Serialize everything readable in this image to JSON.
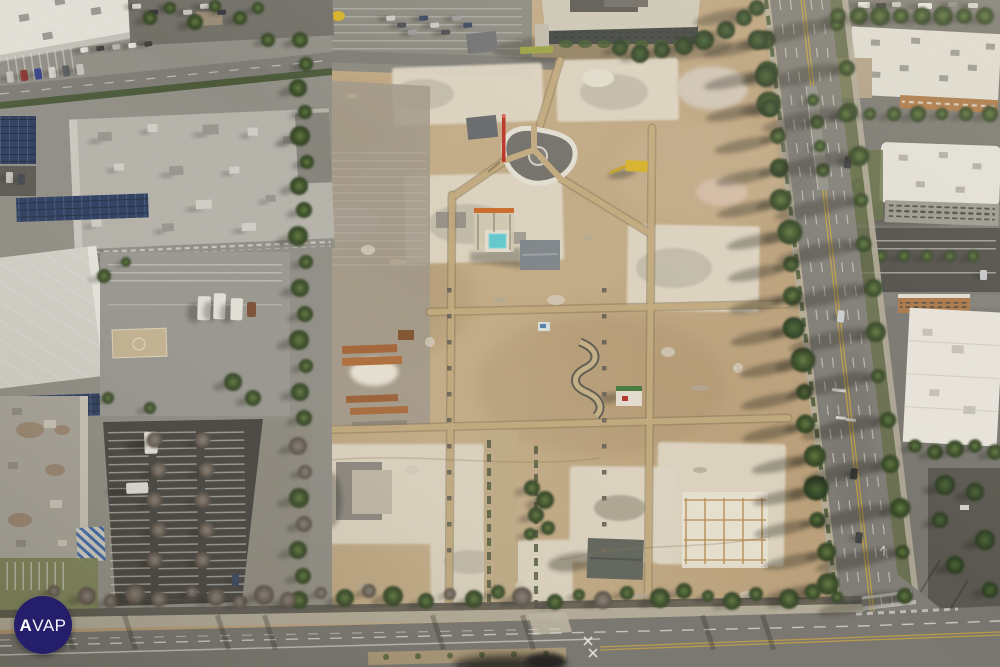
{
  "watermark": {
    "full_text": "AVAP",
    "text_bold": "A",
    "text_light": "VAP",
    "background_color": "#241e6b",
    "text_color": "#ffffff"
  },
  "palette": {
    "logo_bg": "#241e6b",
    "logo_fg": "#ffffff",
    "dirt_light": "#cdb893",
    "dirt_mid": "#bb9e77",
    "dirt_dark": "#97794f",
    "pad_white": "#e4ddcb",
    "rubble_gray": "#c7c0b0",
    "asphalt_light": "#999892",
    "asphalt_mid": "#7c7b75",
    "asphalt_dark": "#3f3e3a",
    "roof_white": "#eae7df",
    "roof_gray": "#b8b7b0",
    "tree_green": "#3e5629",
    "tree_dark": "#2c4020",
    "tree_bare": "#7d746a",
    "grass_green": "#5f6a40",
    "solar_blue": "#22365c",
    "lane_yellow": "#c9a33b",
    "lane_white": "#f2f2ee",
    "crane_red": "#c0281e",
    "machine_yellow": "#ddb51f",
    "pool_cyan": "#5ecfd6",
    "rust_orange": "#a4612f",
    "facade_brown": "#ab7440",
    "court_tan": "#c9b995",
    "handicap_blue": "#2f5fae",
    "shadow": "#12160d"
  }
}
